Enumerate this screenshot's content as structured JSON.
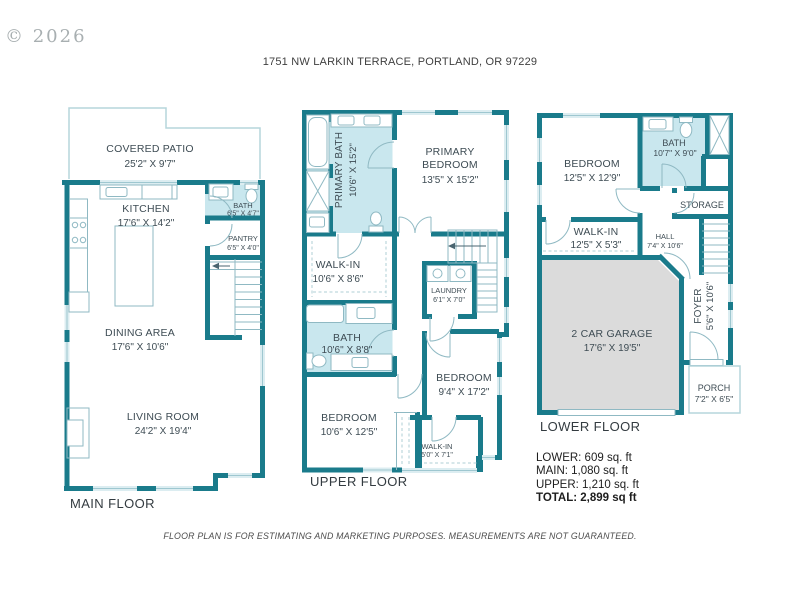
{
  "watermark": "© 2026",
  "title": "1751 NW LARKIN TERRACE, PORTLAND, OR 97229",
  "floors": {
    "main": {
      "label": "MAIN FLOOR",
      "rooms": {
        "covered_patio": {
          "name": "COVERED PATIO",
          "dims": "25'2\" X 9'7\""
        },
        "kitchen": {
          "name": "KITCHEN",
          "dims": "17'6\" X 14'2\""
        },
        "bath": {
          "name": "BATH",
          "dims": "6'5\" X 4'7\""
        },
        "pantry": {
          "name": "PANTRY",
          "dims": "6'5\" X 4'0\""
        },
        "dining_area": {
          "name": "DINING AREA",
          "dims": "17'6\" X 10'6\""
        },
        "living_room": {
          "name": "LIVING ROOM",
          "dims": "24'2\" X 19'4\""
        }
      }
    },
    "upper": {
      "label": "UPPER FLOOR",
      "rooms": {
        "primary_bath": {
          "name": "PRIMARY BATH",
          "dims": "10'6\" X 15'2\""
        },
        "primary_bedroom": {
          "name1": "PRIMARY",
          "name2": "BEDROOM",
          "dims": "13'5\" X 15'2\""
        },
        "walk_in": {
          "name": "WALK-IN",
          "dims": "10'6\" X 8'6\""
        },
        "laundry": {
          "name": "LAUNDRY",
          "dims": "6'1\" X 7'0\""
        },
        "bath": {
          "name": "BATH",
          "dims": "10'6\" X 8'8\""
        },
        "bedroom_right": {
          "name": "BEDROOM",
          "dims": "9'4\" X 17'2\""
        },
        "bedroom_left": {
          "name": "BEDROOM",
          "dims": "10'6\" X 12'5\""
        },
        "walk_in_small": {
          "name": "WALK-IN",
          "dims": "5'0\" X 7'1\""
        }
      }
    },
    "lower": {
      "label": "LOWER FLOOR",
      "rooms": {
        "bedroom": {
          "name": "BEDROOM",
          "dims": "12'5\" X 12'9\""
        },
        "bath": {
          "name": "BATH",
          "dims": "10'7\" X 9'0\""
        },
        "storage": {
          "name": "STORAGE"
        },
        "walk_in": {
          "name": "WALK-IN",
          "dims": "12'5\" X 5'3\""
        },
        "hall": {
          "name": "HALL",
          "dims": "7'4\" X 10'6\""
        },
        "garage": {
          "name": "2 CAR GARAGE",
          "dims": "17'6\" X 19'5\""
        },
        "foyer": {
          "name": "FOYER",
          "dims": "5'6\" X 10'6\""
        },
        "porch": {
          "name": "PORCH",
          "dims": "7'2\" X 6'5\""
        }
      }
    }
  },
  "areas": {
    "lower": "LOWER: 609 sq. ft",
    "main": "MAIN: 1,080 sq. ft",
    "upper": "UPPER: 1,210 sq. ft",
    "total": "TOTAL: 2,899 sq ft"
  },
  "disclaimer": "FLOOR PLAN IS FOR ESTIMATING AND MARKETING PURPOSES. MEASUREMENTS ARE NOT GUARANTEED.",
  "colors": {
    "wall": "#1A7B8B",
    "bath_fill": "#C9E7EE",
    "garage_fill": "#DBDBDB",
    "line": "#8FB9C3",
    "window": "#DCEDF1",
    "text": "#3E4C54",
    "floor_label": "#333B40"
  }
}
